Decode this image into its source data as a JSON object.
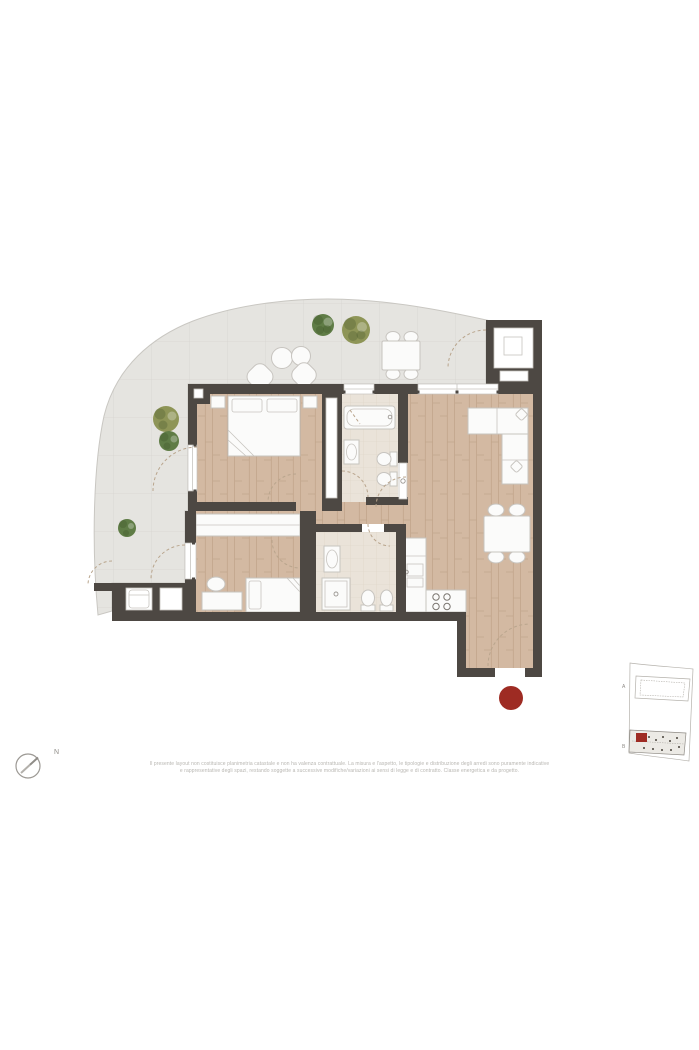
{
  "colors": {
    "wall": "#4d4843",
    "wood": "#d3b9a2",
    "wood-line": "#c2a58b",
    "bath-floor": "#eae3d9",
    "bath-line": "#ddd3c4",
    "terrace": "#e5e4e0",
    "terrace-line": "#d7d5d0",
    "terrace-outline": "#c9c7c2",
    "furniture-fill": "#fbfbfa",
    "furniture-stroke": "#c7c4bf",
    "fixture-stroke": "#9b9792",
    "arc": "#b9a58d",
    "tree-dark": "#5f7c46",
    "tree-olive": "#8e9557",
    "accent-red": "#9e2b23",
    "keyplan-stroke": "#b5b2ac",
    "text-muted": "#b8b6b1",
    "compass-stroke": "#9c9994"
  },
  "compass": {
    "label": "N"
  },
  "key_plan": {
    "building_a_label": "A",
    "building_b_label": "B"
  },
  "entrance_marker": {
    "color": "#9e2b23"
  },
  "disclaimer": {
    "line1": "Il presente layout non costituisce planimetria catastale e non ha valenza contrattuale. La misura e l'aspetto, le tipologie e distribuzione degli arredi sono puramente indicative",
    "line2": "e rappresentative degli spazi, restando soggette a successive modifiche/variazioni ai sensi di legge e di contratto. Classe energetica e da progetto."
  }
}
